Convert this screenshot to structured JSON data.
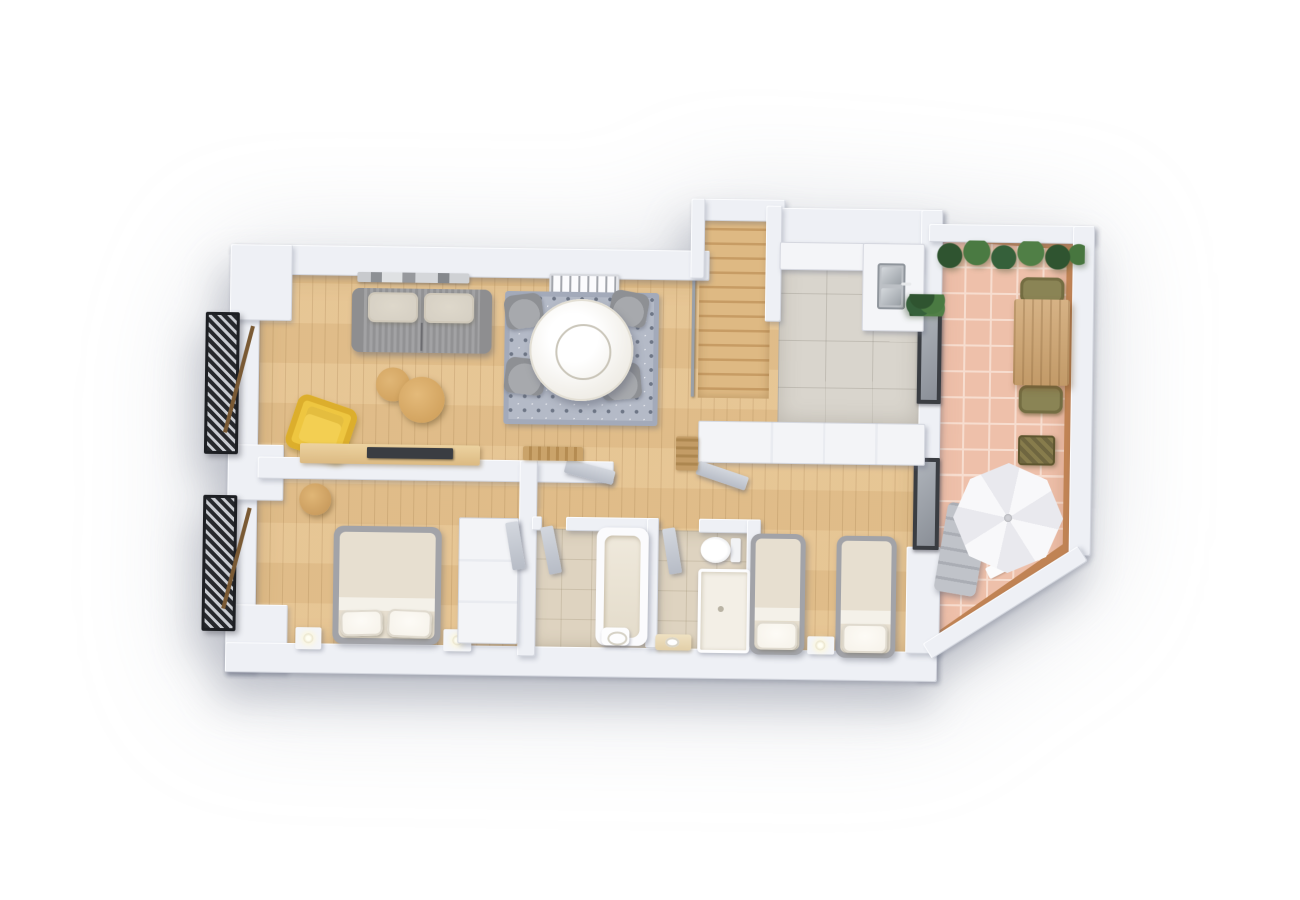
{
  "scene": {
    "kind": "3d-floor-plan-render",
    "view": "top-down",
    "background": "#ffffff",
    "text_visible": false
  },
  "palette": {
    "wall": "#eef0f5",
    "counter": "#f4f5f8",
    "wood": "#e5c28e",
    "woodDark": "#cfa66d",
    "kitchenTile": "#d9d5cd",
    "bathTile": "#ded3c0",
    "terraceTile": "#eec0aa",
    "terraceGrout": "#f7ddcf",
    "terraceWood": "#c08354",
    "rug": "#b4bac7",
    "sofa": "#9b9b9d",
    "cushion": "#d4cec2",
    "accentYellow": "#eec640",
    "tableWood": "#d2a35f",
    "marble": "#f3f1ec",
    "chairGray": "#8e9094",
    "bedFrame": "#a2a3a8",
    "blanket": "#e7dfd0",
    "pillow": "#f5f1e8",
    "plantGreen": "#41663c",
    "oliveChair": "#8a8455",
    "wicker": "#80764a",
    "steel": "#bcc0c5",
    "frameDark": "#26282c",
    "parasol": "#f5f5f7",
    "lounger": "#c0c3c9",
    "tv": "#3a3d42"
  },
  "rooms": [
    {
      "name": "living-dining-room",
      "floor": "wood-planks",
      "furniture": [
        "gray-sofa-with-two-cushions",
        "chrome-wall-shelf",
        "ornate-ceiling-lamp",
        "round-marble-dining-table",
        "four-gray-dining-chairs",
        "patterned-blue-rug",
        "two-round-wooden-coffee-tables",
        "yellow-armchair",
        "tv-sideboard-with-tv",
        "wooden-doormat"
      ]
    },
    {
      "name": "staircase",
      "floor": "wood-steps",
      "furniture": [
        "handrail"
      ]
    },
    {
      "name": "kitchen",
      "floor": "gray-tile",
      "furniture": [
        "l-shaped-white-counter",
        "stainless-double-sink",
        "lower-cabinet"
      ]
    },
    {
      "name": "hallway",
      "floor": "wood-planks",
      "furniture": [
        "built-in-cabinet-row",
        "open-cabinet-door",
        "small-runner-mat"
      ]
    },
    {
      "name": "master-bedroom",
      "floor": "wood-planks",
      "furniture": [
        "double-bed",
        "two-pillows",
        "nightstand-with-lamp-left",
        "nightstand-with-lamp-right",
        "tall-wardrobe-with-open-door",
        "round-side-table"
      ]
    },
    {
      "name": "bathroom-1",
      "floor": "beige-tile",
      "furniture": [
        "bathtub",
        "wall-washbasin",
        "open-door"
      ]
    },
    {
      "name": "bathroom-2",
      "floor": "beige-tile",
      "furniture": [
        "toilet",
        "shower-tray",
        "vanity-washbasin",
        "open-door"
      ]
    },
    {
      "name": "bedroom-2",
      "floor": "wood-planks",
      "furniture": [
        "single-bed-left",
        "single-bed-right",
        "shared-nightstand",
        "wardrobe-band"
      ]
    },
    {
      "name": "terrace",
      "floor": "terracotta-tile-with-white-grout",
      "furniture": [
        "plant-hedge-planter",
        "wooden-outdoor-table",
        "two-olive-chairs",
        "wicker-stool",
        "white-octagonal-parasol",
        "gray-sun-lounger",
        "white-towel"
      ]
    }
  ],
  "openings": {
    "windows": [
      "living-room-left-window-with-shutter",
      "master-bedroom-left-window-with-shutter",
      "kitchen-to-terrace-window",
      "bedroom2-to-terrace-window"
    ],
    "doors": [
      "living-to-corridor-open-door",
      "bathroom1-open-door",
      "bathroom2-open-door",
      "hall-cabinet-open-door",
      "wardrobe-open-door"
    ]
  },
  "structure": [
    "thick-white-outer-walls",
    "diagonal-terrace-corner-wall",
    "soft-drop-shadow-around-building"
  ]
}
